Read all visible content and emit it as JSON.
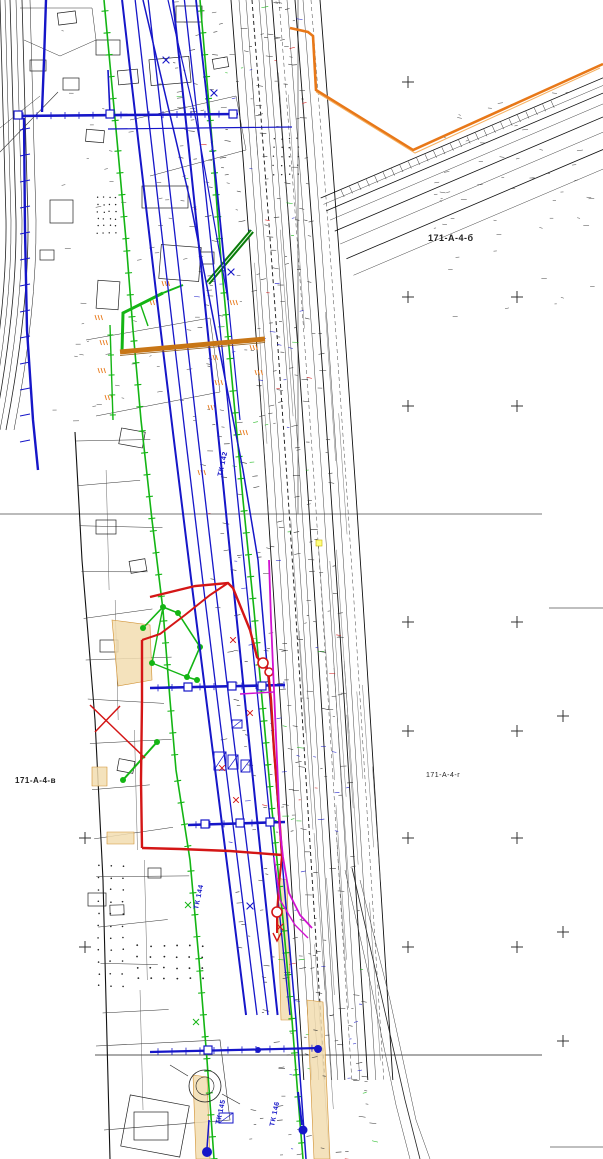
{
  "map": {
    "kind_note": "scanned engineering utility survey plan sheet",
    "sheet_labels": [
      {
        "text": "171-А-4-б"
      },
      {
        "text": "171-А-4-в"
      },
      {
        "text": "171-А-4-г"
      }
    ],
    "chamber_labels": [
      {
        "text": "ТК 142"
      },
      {
        "text": "ТК 144"
      },
      {
        "text": "ТК 145"
      },
      {
        "text": "ТК 146"
      }
    ],
    "colors": {
      "paper": "#ffffff",
      "ink": "#1a1a1a",
      "blue": "#1616c8",
      "green": "#14b514",
      "dark_green": "#0a7a0a",
      "red": "#d41616",
      "magenta": "#d012d0",
      "orange": "#e87818",
      "brown": "#c87616",
      "tan": "#f2ddb0",
      "tan_border": "#d09030",
      "grid_cross": "#333333",
      "sheet_line": "#777777"
    }
  }
}
